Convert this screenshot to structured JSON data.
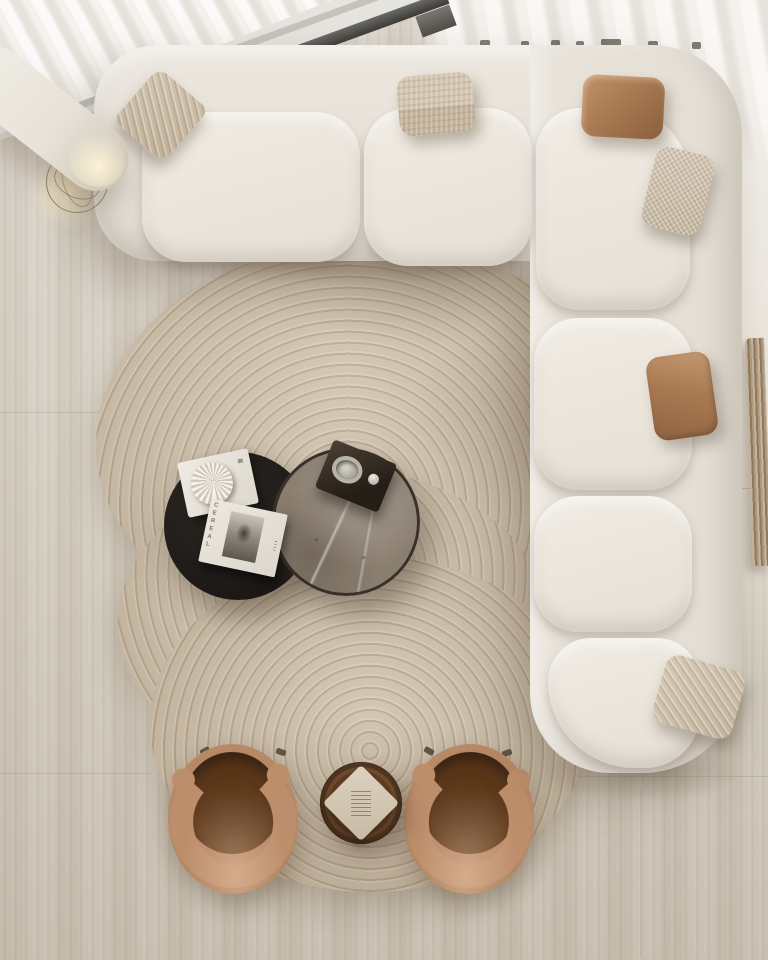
{
  "scene": {
    "description": "Top-down view of a minimalist neutral living room: L-shaped cream boucle sectional sofa with throw pillows, organic ribbed beige rug, nesting round coffee tables (black and gray marble) with books and decor, two caramel velvet barrel armchairs, round carved wood side table with a booklet, arched floor lamp with wire base, sheer white curtains and travertine floor."
  },
  "palette": {
    "floor": "#d6cfc4",
    "rug": "#cdbfa9",
    "sofa_shell": "#e8e3da",
    "seat_cushion": "#efeae2",
    "pillow_beige": "#cbbca6",
    "pillow_velvet": "#a97a52",
    "table_black": "#1c1916",
    "table_marble": "#8e8276",
    "side_table_wood": "#5d3c22",
    "chair_velvet": "#b98a67",
    "chair_seat": "#5f3a1e",
    "curtain": "#f7f5f1",
    "window_frame": "#3f3e3b",
    "lamp_glow": "#ffeccb"
  },
  "objects": {
    "sofa": {
      "label": "L-shaped boucle sectional sofa",
      "sections": 5,
      "pillow_count": 6
    },
    "pillows": [
      {
        "label": "woven beige diamond pillow"
      },
      {
        "label": "striped beige pillow"
      },
      {
        "label": "caramel velvet pillow top"
      },
      {
        "label": "checkered beige corner pillow"
      },
      {
        "label": "caramel velvet pillow right"
      },
      {
        "label": "woven beige bottom corner pillow"
      }
    ],
    "coffee_tables": {
      "black": {
        "label": "round black coffee table"
      },
      "marble": {
        "label": "round gray marble coffee table"
      }
    },
    "magazine": {
      "spine_title": "CEREAL"
    },
    "book_shell": {
      "label": "white art book with sculptural shell"
    },
    "decor_tray": {
      "label": "dark tray with glass ring and metal sphere"
    },
    "armchairs": {
      "left": {
        "label": "caramel velvet barrel armchair"
      },
      "right": {
        "label": "caramel velvet barrel armchair"
      }
    },
    "side_table": {
      "label": "round carved wood side table"
    },
    "side_table_book": {
      "label": "small beige booklet"
    },
    "floor_lamp": {
      "label": "arched floor lamp with wire cage base"
    },
    "curtains": {
      "label": "sheer white curtains"
    },
    "window": {
      "label": "dark window frame"
    },
    "fluted_panel": {
      "label": "fluted wood decor at right wall"
    }
  }
}
